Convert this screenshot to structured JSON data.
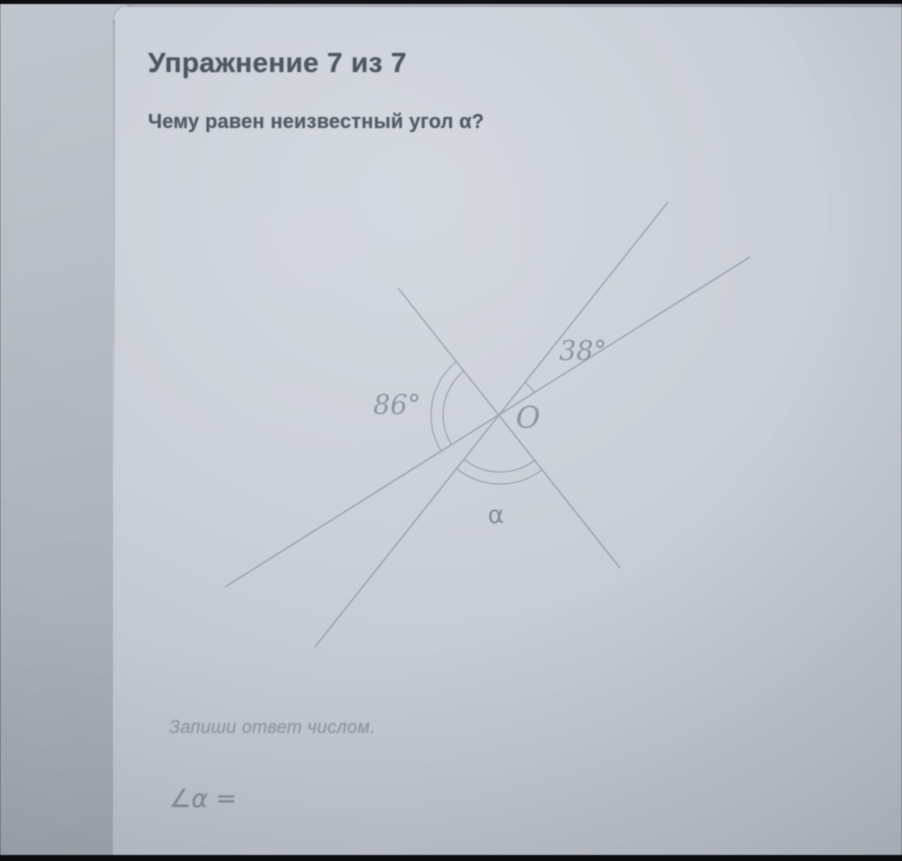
{
  "exercise": {
    "title": "Упражнение 7 из 7",
    "question": "Чему равен неизвестный угол α?"
  },
  "diagram": {
    "point_label": "O",
    "center": {
      "x": 500,
      "y": 415
    },
    "rays": {
      "A": {
        "x": 668,
        "y": 202
      },
      "B": {
        "x": 750,
        "y": 257
      },
      "C": {
        "x": 398,
        "y": 288
      },
      "D": {
        "x": 225,
        "y": 587
      },
      "E": {
        "x": 315,
        "y": 647
      },
      "F": {
        "x": 620,
        "y": 568
      }
    },
    "lines": [
      {
        "from": "A",
        "to": "E"
      },
      {
        "from": "B",
        "to": "D"
      },
      {
        "from": "C",
        "to": "F"
      }
    ],
    "arcs": [
      {
        "name": "angle-38-arc",
        "from": "B",
        "to": "A",
        "radii": [
          41
        ]
      },
      {
        "name": "angle-86-arc",
        "from": "C",
        "to": "D",
        "radii": [
          57,
          69
        ]
      },
      {
        "name": "angle-alpha-arc",
        "from": "E",
        "to": "F",
        "radii": [
          57,
          69
        ]
      }
    ],
    "labels": [
      {
        "name": "angle-38-label",
        "text": "38°",
        "x": 583,
        "y": 360,
        "style": "serif",
        "size": 27
      },
      {
        "name": "angle-86-label",
        "text": "86°",
        "x": 397,
        "y": 414,
        "style": "serif",
        "size": 27
      },
      {
        "name": "point-O-label",
        "text": "O",
        "x": 528,
        "y": 428,
        "style": "serif",
        "size": 30
      },
      {
        "name": "angle-alpha-label",
        "text": "α",
        "x": 496,
        "y": 523,
        "style": "sans",
        "size": 25
      }
    ],
    "line_color": "#99a0ac",
    "label_color": "#8b93a0"
  },
  "answer": {
    "instruction": "Запиши ответ числом.",
    "prompt": "∠α =",
    "value": ""
  },
  "colors": {
    "bezel": "#0a0b0d",
    "page_bg": "#aeb5be",
    "card_bg": "#c9ced7",
    "text_dark": "#49525c",
    "text_muted": "#929aa6"
  }
}
